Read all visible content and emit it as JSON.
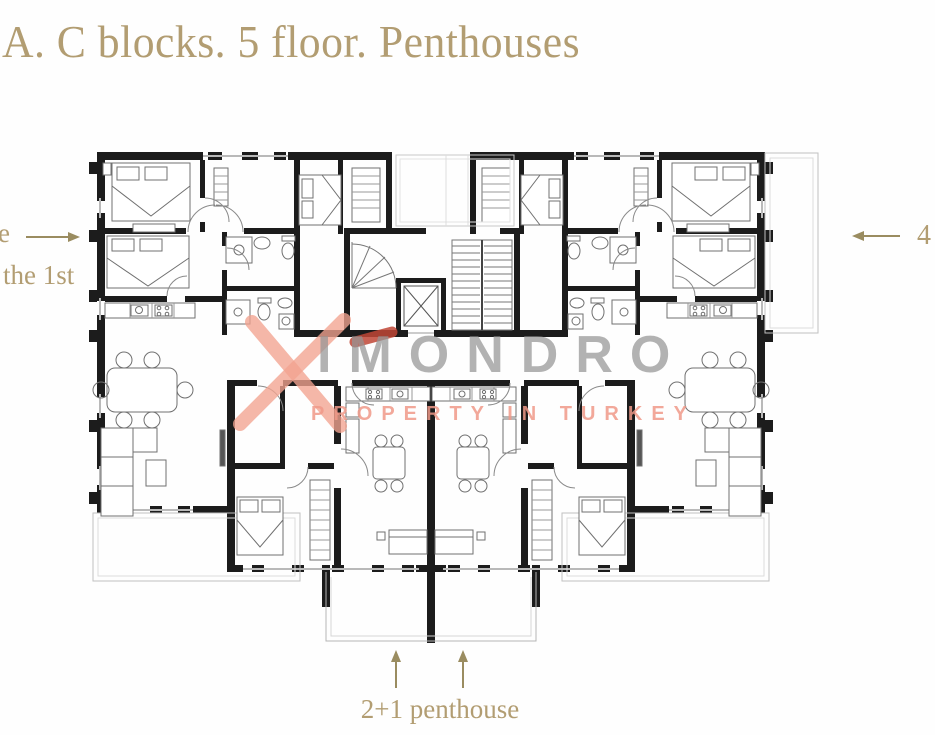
{
  "title": {
    "text": "A. C blocks. 5 floor. Penthouses"
  },
  "annotations": {
    "left_fragment": "e",
    "left_label": "the 1st",
    "right_label": "4",
    "bottom_label": "2+1 penthouse"
  },
  "watermark": {
    "brand": "IMONDRO",
    "tagline": "PROPERTY IN TURKEY"
  },
  "colors": {
    "title_gold": "#b29d72",
    "arrow_olive": "#9a8c60",
    "wall_black": "#1c1c1c",
    "watermark_gray": "#949494",
    "watermark_salmon": "#f2a38f",
    "logo_dark_red": "#bf4636",
    "balcony_gray": "#c0c0c0"
  }
}
